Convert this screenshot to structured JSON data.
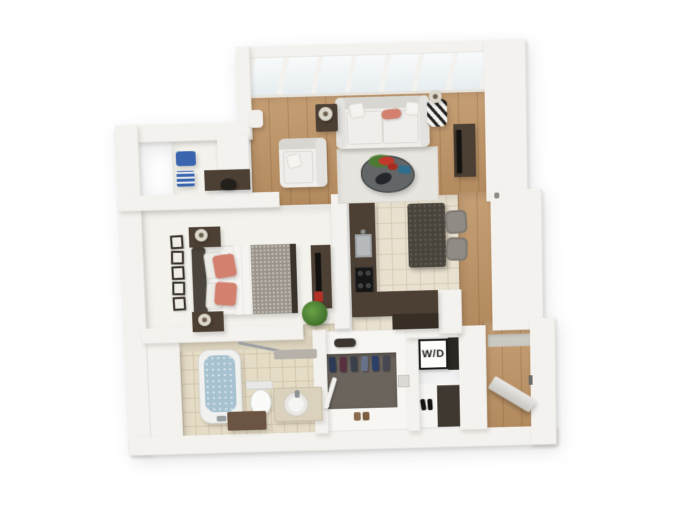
{
  "scene": {
    "description": "3D isometric rendering of a one-bedroom apartment floor plan on a white background",
    "background": "#ffffff"
  },
  "labels": {
    "washer_dryer": "W/D"
  },
  "palette": {
    "wall": "#f4f2ee",
    "wood": "#c09465",
    "tile": "#e9e1d0",
    "tileLine": "#d7cbb3",
    "bathTile": "#e5dcc6",
    "bathTileLine": "#d2c6ac",
    "carpet": "#f4f2ec",
    "rug": "#e7e5df",
    "sofa": "#efeeeb",
    "sofaShade": "#d8d6d1",
    "coral": "#d3806f",
    "darkWood": "#4c3f33",
    "espresso": "#372e25",
    "granite": "#48433b",
    "steel": "#b7babc",
    "water": "#a6c1d0",
    "closetFloor": "#6a645c",
    "blanket": "#9a948a",
    "stool": "#908b84",
    "plant": "#4c7a33",
    "blue": "#3a66b0",
    "red": "#b23227",
    "black": "#141210"
  },
  "rooms": [
    {
      "name": "living-room",
      "items": [
        "window-wall",
        "sofa",
        "coral-accent-pillow",
        "armchair",
        "area-rug",
        "coffee-table",
        "flower-centerpiece",
        "end-table-left",
        "end-table-right",
        "table-lamps",
        "striped-accent-stool",
        "tv-console",
        "television"
      ]
    },
    {
      "name": "desk-nook",
      "items": [
        "desk",
        "desk-chair",
        "blue-storage-bin",
        "blue-books"
      ]
    },
    {
      "name": "bedroom",
      "items": [
        "bed",
        "headboard",
        "coral-pillows",
        "white-duvet",
        "gray-blanket",
        "nightstand-top",
        "nightstand-bottom",
        "table-lamps",
        "wall-frames",
        "media-console",
        "television",
        "red-accent",
        "potted-plant"
      ]
    },
    {
      "name": "kitchen",
      "items": [
        "l-shaped-counter",
        "double-sink",
        "cooktop",
        "peninsula-counter",
        "island",
        "bar-stool-1",
        "bar-stool-2"
      ]
    },
    {
      "name": "bathroom",
      "items": [
        "bathtub",
        "shower-rod",
        "toilet",
        "vanity",
        "round-sink",
        "storage-cabinet",
        "shelf"
      ]
    },
    {
      "name": "walk-in-closet",
      "items": [
        "hanging-clothes",
        "duffel-bag",
        "storage-box",
        "closet-pole",
        "shoes"
      ]
    },
    {
      "name": "laundry-closet",
      "items": [
        "washer-dryer-unit",
        "shoe-shelf",
        "shoes"
      ]
    },
    {
      "name": "entry",
      "items": [
        "front-door",
        "floor-mat",
        "wood-floor"
      ]
    }
  ]
}
